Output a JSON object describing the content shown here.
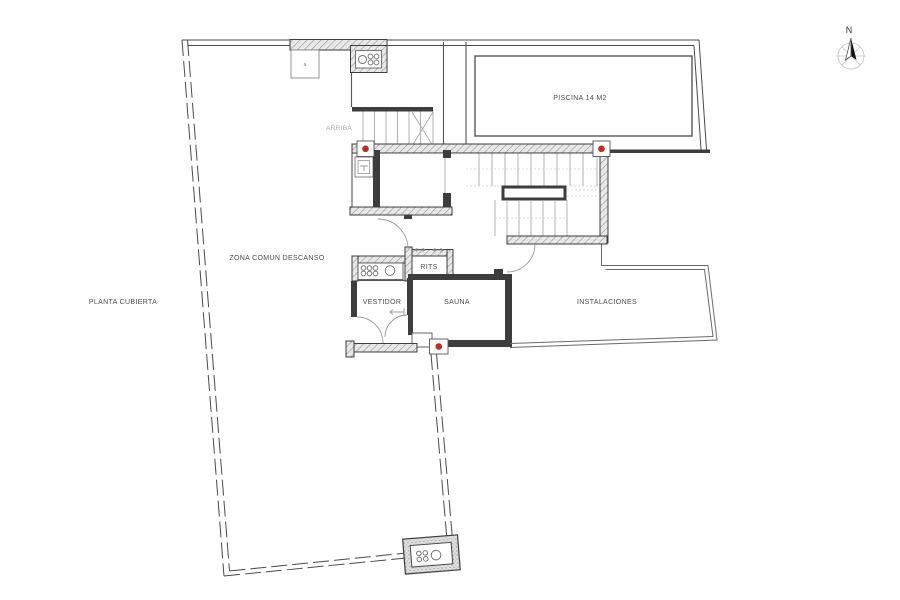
{
  "labels": {
    "plan_title": "PLANTA CUBIERTA",
    "common_area": "ZONA COMUN DESCANSO",
    "pool": "PISCINA 14 M2",
    "stairs_up": "ARRIBA",
    "rits": "RITS",
    "dressing_room": "VESTIDOR",
    "sauna": "SAUNA",
    "installations": "INSTALACIONES",
    "small_closet": "a",
    "compass_north": "N"
  },
  "colors": {
    "marker_red": "#c22a22",
    "wall_dark": "#3d3d3d",
    "hatch_gray": "#9a9a9a",
    "background": "#ffffff"
  }
}
